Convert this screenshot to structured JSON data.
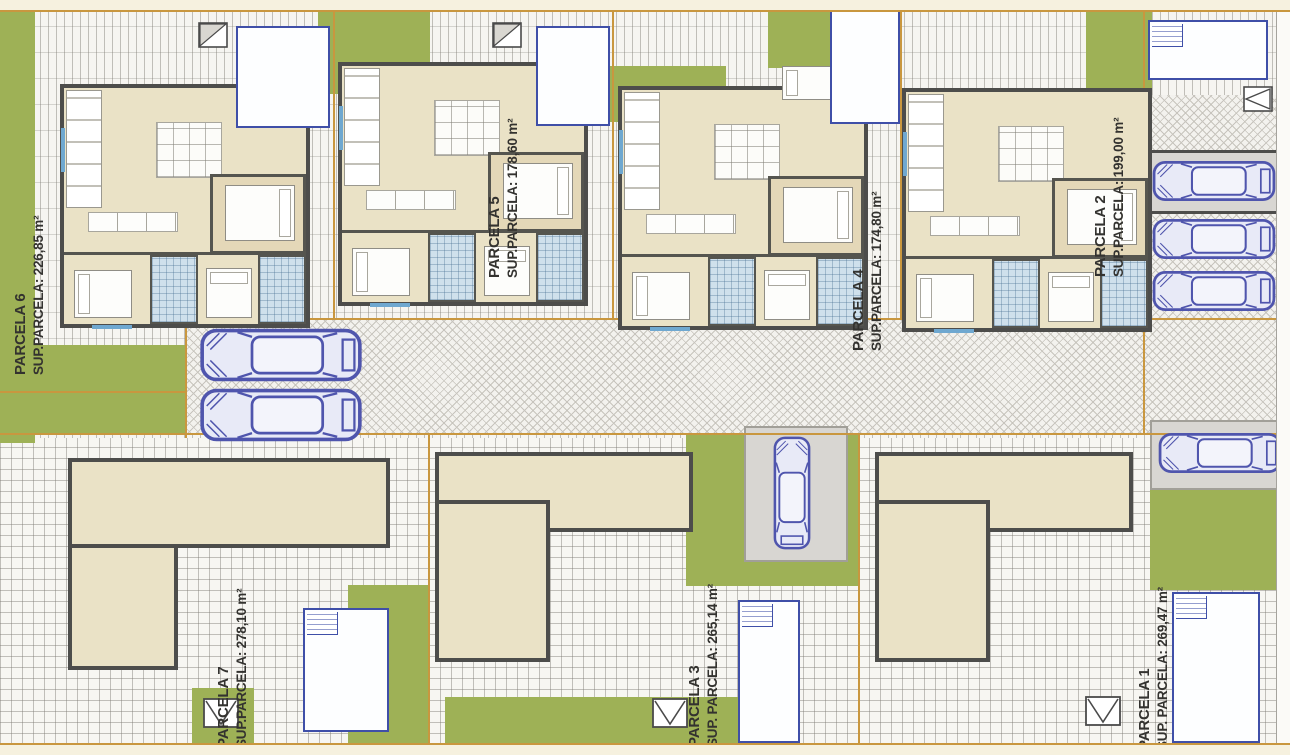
{
  "parcels": [
    {
      "id": "parcela-6",
      "name": "PARCELA 6",
      "area_label": "SUP.PARCELA: 226,85 m²"
    },
    {
      "id": "parcela-5",
      "name": "PARCELA 5",
      "area_label": "SUP.PARCELA: 178,60 m²"
    },
    {
      "id": "parcela-4",
      "name": "PARCELA 4",
      "area_label": "SUP.PARCELA: 174,80 m²"
    },
    {
      "id": "parcela-2",
      "name": "PARCELA 2",
      "area_label": "SUP.PARCELA: 199,00 m²"
    },
    {
      "id": "parcela-7",
      "name": "PARCELA 7",
      "area_label": "SUP.PARCELA: 278,10 m²"
    },
    {
      "id": "parcela-3",
      "name": "PARCELA 3",
      "area_label": "SUP. PARCELA: 265,14 m²"
    },
    {
      "id": "parcela-1",
      "name": "PARCELA 1",
      "area_label": "SUP. PARCELA: 269,47 m²"
    }
  ],
  "colors": {
    "green_area": "#9eb156",
    "boundary_tan": "#c9973f",
    "pool_border": "#3f4fa8",
    "car_blue": "#4f55ad",
    "wall_dark": "#4d4d4b",
    "interior_beige": "#eae2c6",
    "bathroom_blue": "#cfe0ec"
  }
}
